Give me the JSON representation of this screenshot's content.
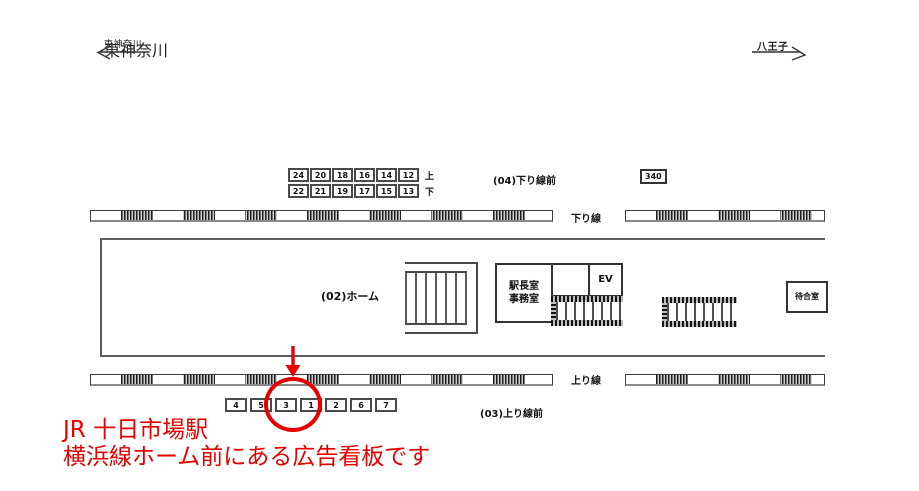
{
  "meta": {
    "background": "#ffffff",
    "accent_red": "#e60000",
    "line_color": "#4a4a4a"
  },
  "directions": {
    "left": {
      "label": "東神奈川"
    },
    "right": {
      "label": "八王子"
    }
  },
  "upper_billboards": {
    "row_up": {
      "numbers": [
        "24",
        "20",
        "18",
        "16",
        "14",
        "12"
      ],
      "suffix": "上"
    },
    "row_down": {
      "numbers": [
        "22",
        "21",
        "19",
        "17",
        "15",
        "13"
      ],
      "suffix": "下"
    },
    "area_label": "(04)下り線前",
    "single_box": "340"
  },
  "tracks": {
    "down_line_label": "下り線",
    "up_line_label": "上り線"
  },
  "platform": {
    "label": "(02)ホーム",
    "office_line1": "駅長室",
    "office_line2": "事務室",
    "elevator_label": "EV",
    "waiting_room_label": "待合室"
  },
  "lower_billboards": {
    "numbers": [
      "4",
      "5",
      "3",
      "1",
      "2",
      "6",
      "7"
    ],
    "highlighted_number": "3",
    "area_label": "(03)上り線前"
  },
  "caption": {
    "line1": "JR 十日市場駅",
    "line2": "横浜線ホーム前にある広告看板です"
  }
}
